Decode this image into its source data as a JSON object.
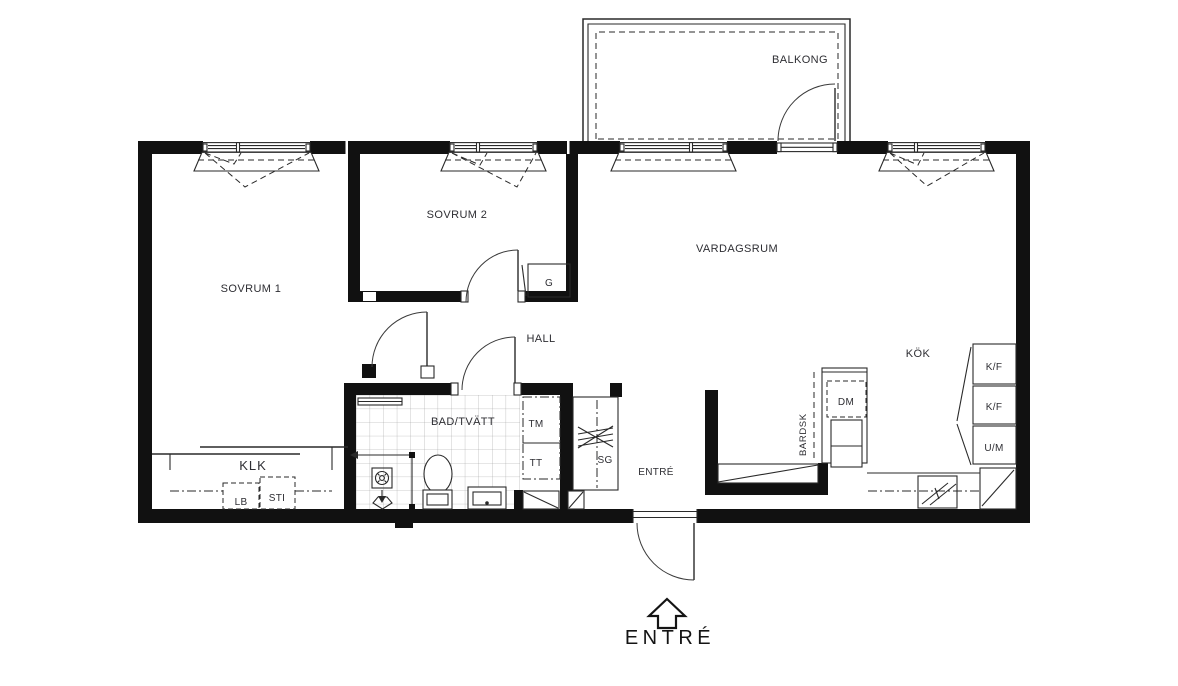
{
  "title": "Apartment floor plan",
  "colors": {
    "wall": "#111111",
    "line": "#2a2a2a",
    "text": "#2e2e33",
    "tile": "#9a9a9a"
  },
  "rooms": {
    "balkong": "BALKONG",
    "sovrum1": "SOVRUM 1",
    "sovrum2": "SOVRUM 2",
    "vardagsrum": "VARDAGSRUM",
    "kok": "KÖK",
    "hall": "HALL",
    "bad_tvatt": "BAD/TVÄTT",
    "klk": "KLK",
    "entre": "ENTRÉ"
  },
  "fixtures": {
    "garderob": "G",
    "tvattmaskin": "TM",
    "torktumlare": "TT",
    "stadgarderob": "SG",
    "diskmaskin": "DM",
    "kyl_frys_upper": "K/F",
    "kyl_frys_lower": "K/F",
    "ugn_micro": "U/M",
    "linneskap": "LB",
    "stadskap": "STI",
    "bardisk": "BARDSK"
  },
  "entrance": {
    "label": "ENTRÉ",
    "direction": "up-arrow"
  }
}
